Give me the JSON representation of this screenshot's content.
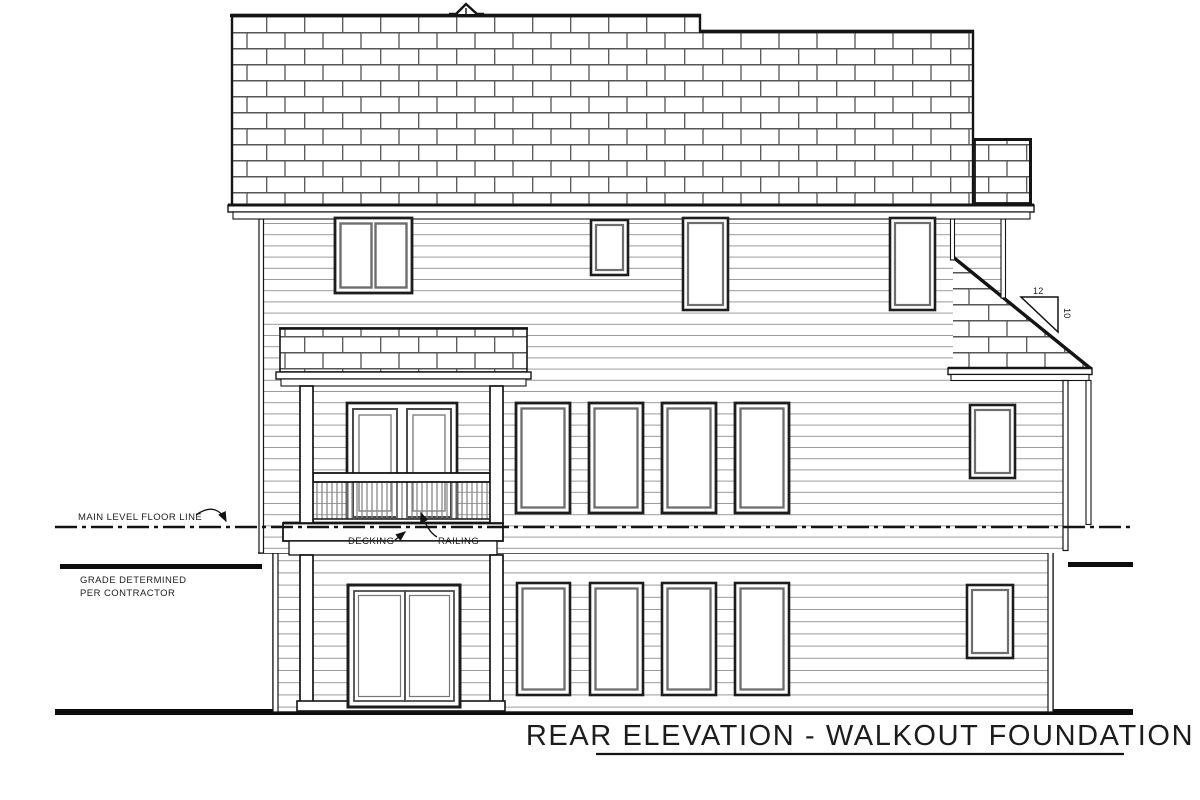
{
  "page": {
    "background": "#ffffff"
  },
  "drawing": {
    "title": "REAR ELEVATION - WALKOUT FOUNDATION",
    "labels": {
      "main_floor_line": "MAIN LEVEL FLOOR LINE",
      "grade_note_line1": "GRADE DETERMINED",
      "grade_note_line2": "PER CONTRACTOR",
      "decking": "DECKING",
      "railing": "RAILING"
    },
    "roof_pitch": {
      "run": "12",
      "rise": "10"
    },
    "colors": {
      "ink": "#141414",
      "siding_line": "#9a9a9a",
      "shingle_line": "#555555",
      "frame_gray": "#6e6e6e",
      "background": "#ffffff"
    }
  }
}
